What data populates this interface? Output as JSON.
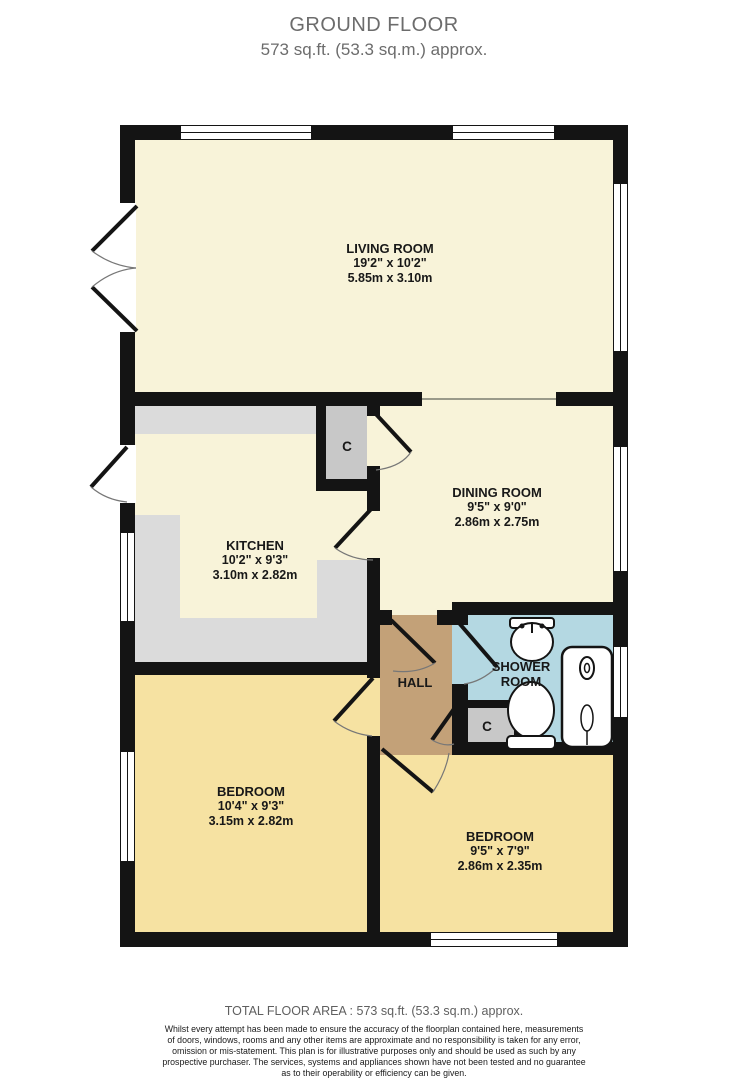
{
  "header": {
    "title": "GROUND FLOOR",
    "subtitle": "573 sq.ft. (53.3 sq.m.) approx."
  },
  "rooms": {
    "living": {
      "name": "LIVING ROOM",
      "imperial": "19'2\"  x 10'2\"",
      "metric": "5.85m  x 3.10m"
    },
    "kitchen": {
      "name": "KITCHEN",
      "imperial": "10'2\"  x 9'3\"",
      "metric": "3.10m  x 2.82m"
    },
    "dining": {
      "name": "DINING ROOM",
      "imperial": "9'5\"  x 9'0\"",
      "metric": "2.86m  x 2.75m"
    },
    "hall": {
      "name": "HALL"
    },
    "shower": {
      "name": "SHOWER ROOM"
    },
    "bedroom1": {
      "name": "BEDROOM",
      "imperial": "10'4\"  x 9'3\"",
      "metric": "3.15m  x 2.82m"
    },
    "bedroom2": {
      "name": "BEDROOM",
      "imperial": "9'5\"  x 7'9\"",
      "metric": "2.86m  x 2.35m"
    },
    "closet_top": {
      "name": "C"
    },
    "closet_bottom": {
      "name": "C"
    }
  },
  "footer": {
    "total_area": "TOTAL FLOOR AREA : 573 sq.ft. (53.3 sq.m.) approx.",
    "disclaimer_lines": [
      "Whilst every attempt has been made to ensure the accuracy of the floorplan contained here, measurements",
      "of doors, windows, rooms and any other items are approximate and no responsibility is taken for any error,",
      "omission or mis-statement. This plan is for illustrative purposes only and should be used as such by any",
      "prospective purchaser. The services, systems and appliances shown have not been tested and no guarantee",
      "as to their operability or efficiency can be given.",
      "Made with Metropix ©2026"
    ]
  },
  "colors": {
    "wall": "#141414",
    "living_dining_kitchen_floor": "#f8f3d9",
    "bedroom_floor": "#f6e2a2",
    "hall_floor": "#c3a178",
    "shower_room_floor": "#b4d8e2",
    "closet": "#c8c8c8",
    "kitchen_counter": "#dbdbdb",
    "title_text": "#6c6c6c"
  }
}
